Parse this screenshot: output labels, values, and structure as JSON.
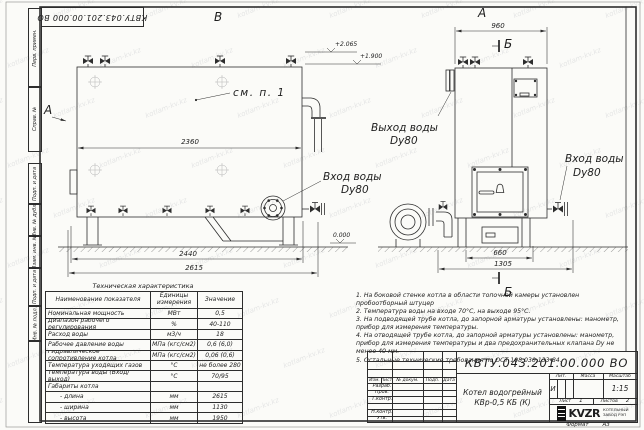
{
  "frame": {
    "stamp": "КВТУ.043.201.00.000  ВО",
    "margin_fields": [
      "Перв. примен.",
      "Справ. №",
      "Подп. и дата",
      "Инв. № дубл.",
      "Взам. инв. №",
      "Подп. и дата",
      "Инв. № подл."
    ],
    "format_label": "Формат",
    "format_value": "А3"
  },
  "watermark_text": "kotlam-kv.kz",
  "drawing": {
    "view_b_label": "В",
    "view_a_label": "А",
    "view_arrow_label": "А",
    "section_label_top": "Б",
    "section_label_bottom": "Б",
    "see_note": "см. п. 1",
    "dims": {
      "shell_length": "2360",
      "support_span": "2440",
      "overall_length": "2615",
      "front_width": "960",
      "door_span": "660",
      "base_span": "1305"
    },
    "elevations": {
      "top": "+2.065",
      "outlet": "+1.900",
      "ground": "0.000"
    },
    "labels": {
      "inlet_b_1": "Вход воды",
      "inlet_b_2": "Dy80",
      "outlet_a_1": "Выход воды",
      "outlet_a_2": "Dy80",
      "inlet_a_1": "Вход воды",
      "inlet_a_2": "Dy80"
    }
  },
  "tech_table": {
    "title": "Техническая характеристика",
    "headers": [
      "Наименование показателя",
      "Единицы измерения",
      "Значение"
    ],
    "rows": [
      [
        "Номинальная мощность",
        "МВт",
        "0,5"
      ],
      [
        "Диапазон рабочего регулирования",
        "%",
        "40-110"
      ],
      [
        "Расход воды",
        "м3/ч",
        "18"
      ],
      [
        "Рабочее давление воды",
        "МПа (кгс/см2)",
        "0,6 (6,0)"
      ],
      [
        "Гидравлическое сопротивление котла",
        "МПа (кгс/см2)",
        "0,06 (0,6)"
      ],
      [
        "Температура уходящих газов",
        "°С",
        "не более 280"
      ],
      [
        "Температура воды (Вход/выход)",
        "°С",
        "70/95"
      ],
      [
        "Габариты котла",
        "",
        ""
      ],
      [
        "- длина",
        "мм",
        "2615"
      ],
      [
        "- ширина",
        "мм",
        "1130"
      ],
      [
        "- высота",
        "мм",
        "1950"
      ]
    ]
  },
  "notes": [
    "1. На боковой стенке котла в области топочной камеры установлен пробоотборный штуцер",
    "2. Температура воды на входе 70°С, на выходе 95°С.",
    "3. На подводящей трубе котла, до запорной арматуры установлены: манометр, прибор для измерения температуры.",
    "4. На отводящей трубе котла, до запорной арматуры установлены: манометр, прибор для измерения температуры и два предохранительных клапана Dу не менее 40 мм.",
    "5. Остальные технические требования по ОСТ 108.030.133-84."
  ],
  "title_block": {
    "doc_number": "КВТУ.043.201.00.000  ВО",
    "name_1": "Котел водогрейный",
    "name_2": "КВр-0,5 КБ (К)",
    "header_cells": [
      "Изм.",
      "Лист",
      "№ докум.",
      "Подп.",
      "Дата"
    ],
    "signers": [
      "Разраб.",
      "Пров.",
      "Т.контр.",
      "",
      "Н.контр.",
      "Утв."
    ],
    "lit_label": "Лит.",
    "mass_label": "Масса",
    "scale_label": "Масштаб",
    "lit_value": "И",
    "scale_value": "1:15",
    "sheet_label": "Лист",
    "sheet_value": "1",
    "sheets_label": "Листов",
    "sheets_value": "2",
    "logo_text": "KVZR",
    "company_line1": "КОТЕЛЬНЫЙ",
    "company_line2": "ЗАВОД РЭП"
  }
}
